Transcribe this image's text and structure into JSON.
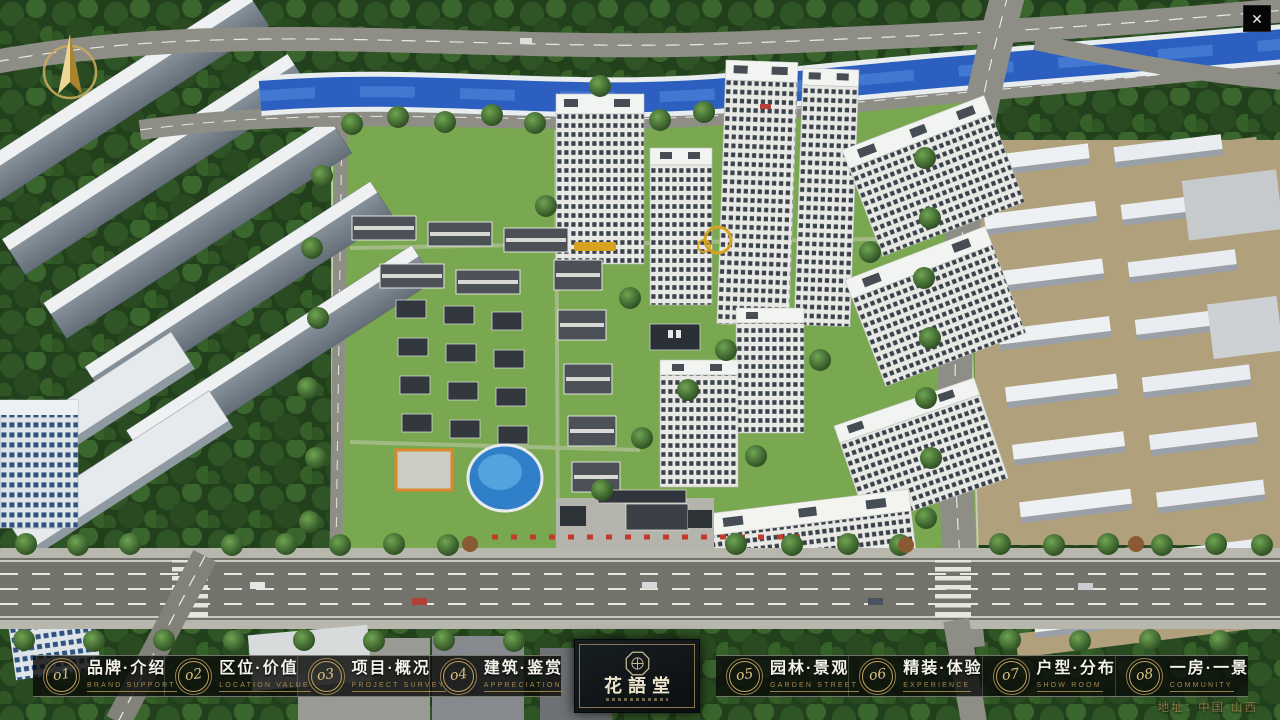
{
  "window": {
    "close_label": "✕"
  },
  "nav": {
    "items": [
      {
        "num": "o1",
        "label": "品牌·介绍",
        "sublabel": "BRAND SUPPORT"
      },
      {
        "num": "o2",
        "label": "区位·价值",
        "sublabel": "LOCATION VALUE"
      },
      {
        "num": "o3",
        "label": "项目·概况",
        "sublabel": "PROJECT SURVEY"
      },
      {
        "num": "o4",
        "label": "建筑·鉴赏",
        "sublabel": "APPRECIATION"
      },
      {
        "num": "o5",
        "label": "园林·景观",
        "sublabel": "GARDEN STREET"
      },
      {
        "num": "o6",
        "label": "精装·体验",
        "sublabel": "EXPERIENCE"
      },
      {
        "num": "o7",
        "label": "户型·分布",
        "sublabel": "SHOW ROOM"
      },
      {
        "num": "o8",
        "label": "一房·一景",
        "sublabel": "COMMUNITY"
      }
    ]
  },
  "logo": {
    "title": "花語堂"
  },
  "footer": {
    "address": "地址：中国·山西"
  },
  "colors": {
    "accent_gold": "#c3a360",
    "nav_panel": "rgba(10,12,9,0.8)",
    "river_blue": "#2c5fc0",
    "lawn_green": "#7aa851"
  }
}
